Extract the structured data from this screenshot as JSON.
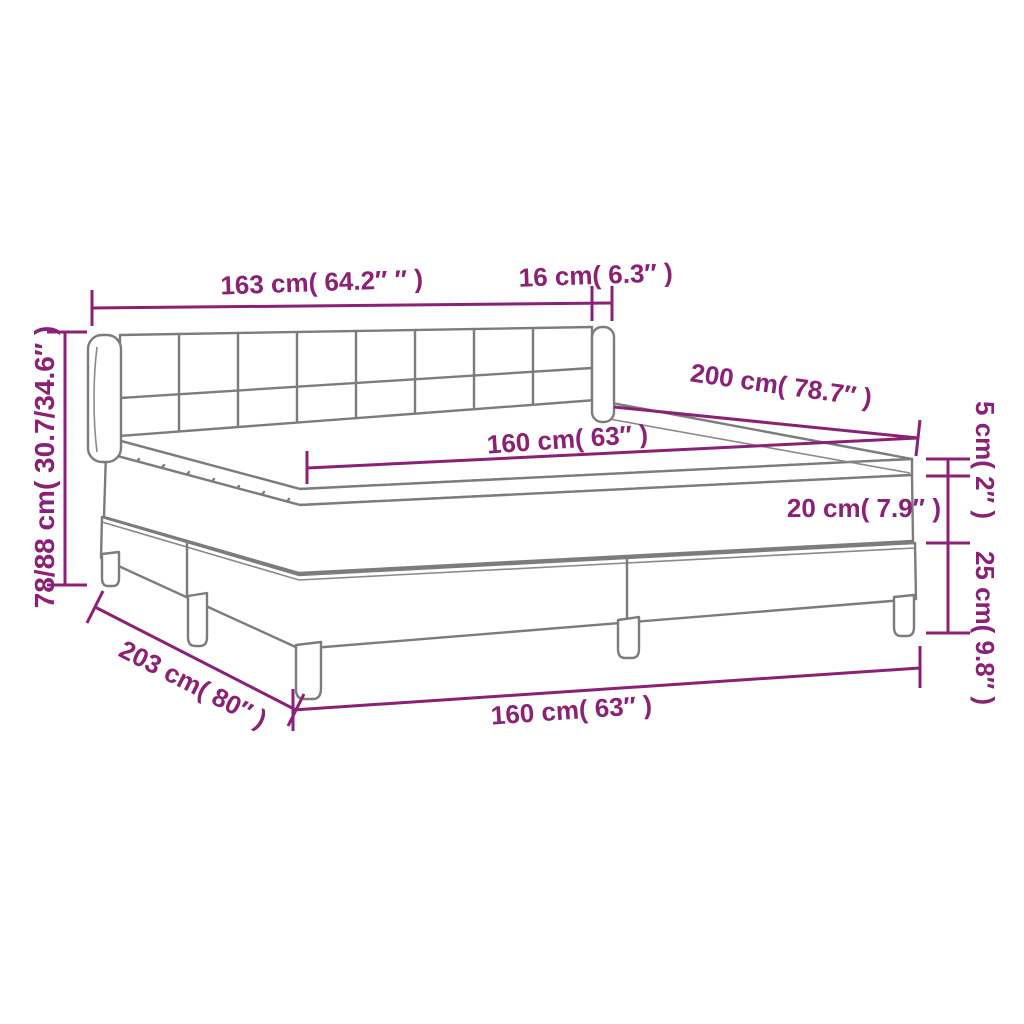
{
  "diagram": {
    "title": "Box spring bed with mattress dimension diagram",
    "colors": {
      "dimension_accent": "#8b2076",
      "drawing_line": "#7c7c7c",
      "background": "#ffffff"
    },
    "labels": {
      "headboard_width": "163 cm( 64.2″ ″ )",
      "wing_depth": "16 cm( 6.3″ )",
      "height_range": "78/88 cm( 30.7/34.6″ )",
      "bed_length_top": "200 cm( 78.7″ )",
      "mattress_width_top": "160 cm( 63″ )",
      "topper_height": "5 cm( 2″ )",
      "mattress_height": "20 cm( 7.9″ )",
      "base_height": "25 cm( 9.8″ )",
      "total_length": "203 cm( 80″ )",
      "mattress_width_bottom": "160 cm( 63″ )"
    }
  }
}
